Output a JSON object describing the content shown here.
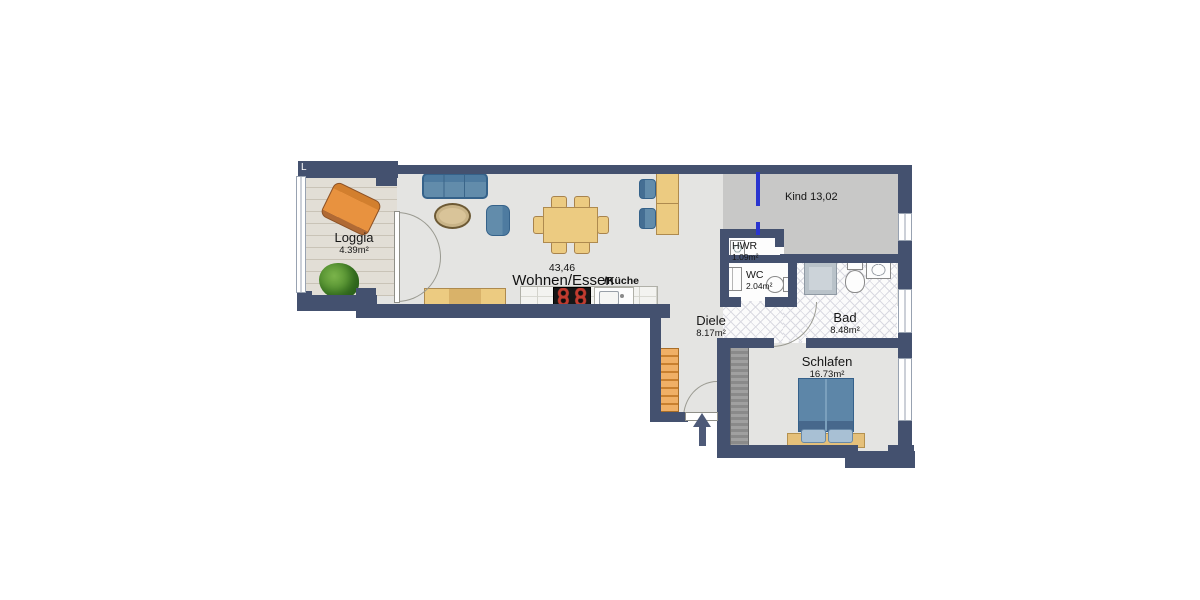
{
  "plan": {
    "corner_mark": "L",
    "labels": {
      "loggia": {
        "name": "Loggia",
        "area": "4.39m²"
      },
      "living": {
        "size": "43,46",
        "name": "Wohnen/Essen",
        "suffix": "/Küche"
      },
      "kind": {
        "name": "Kind 13,02"
      },
      "hwr": {
        "name": "HWR",
        "area": "1.09m²"
      },
      "wc": {
        "name": "WC",
        "area": "2.04m²"
      },
      "bad": {
        "name": "Bad",
        "area": "8.48m²"
      },
      "diele": {
        "name": "Diele",
        "area": "8.17m²"
      },
      "schlafen": {
        "name": "Schlafen",
        "area": "16.73m²"
      }
    },
    "colors": {
      "wall": "#44516f",
      "planned_wall_line": "#2a35cf",
      "floor": "#e4e4e2",
      "kind_floor": "#c8c8c7",
      "tile_line": "#d9d9e1",
      "wood_furniture": "#eccb81",
      "upholstery_blue": "#628cab",
      "deck_wood": "#e2ded6",
      "shelf_orange": "#efa757"
    }
  }
}
